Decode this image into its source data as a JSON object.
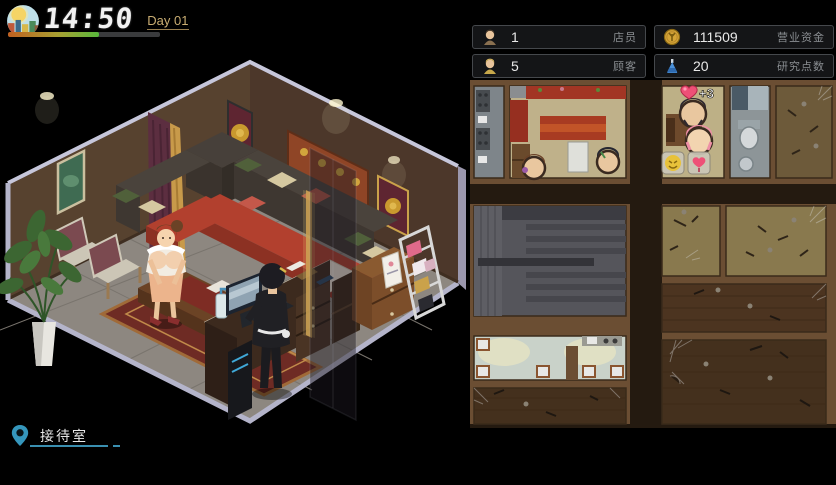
{
  "hud": {
    "clock_time": "14:50",
    "day_label": "Day 01",
    "day_progress_pct": 60
  },
  "location": {
    "name": "接待室"
  },
  "stats": {
    "staff": {
      "value": "1",
      "label": "店员",
      "icon": "staff-icon"
    },
    "funds": {
      "value": "111509",
      "label": "营业资金",
      "icon": "coin-icon"
    },
    "customers": {
      "value": "5",
      "label": "顾客",
      "icon": "customer-icon"
    },
    "research": {
      "value": "20",
      "label": "研究点数",
      "icon": "flask-icon"
    }
  },
  "minimap": {
    "affection_gain": "+3",
    "status_icons": [
      "happy-emoji-icon",
      "heart-balloon-icon"
    ]
  },
  "colors": {
    "accent_cyan": "#3a8fb0",
    "day_label": "#c9ad72",
    "progress_start": "#c06020",
    "progress_end": "#58b83c",
    "chip_border": "#45484c",
    "stat_label_gray": "#8a8e92",
    "heart_pink": "#ee5077",
    "coin_gold": "#d4a437",
    "flask_blue": "#4a90d8",
    "wall_brown": "#57422f",
    "floor_gray": "#8d8780",
    "minimap_wall": "#6b4e33"
  }
}
